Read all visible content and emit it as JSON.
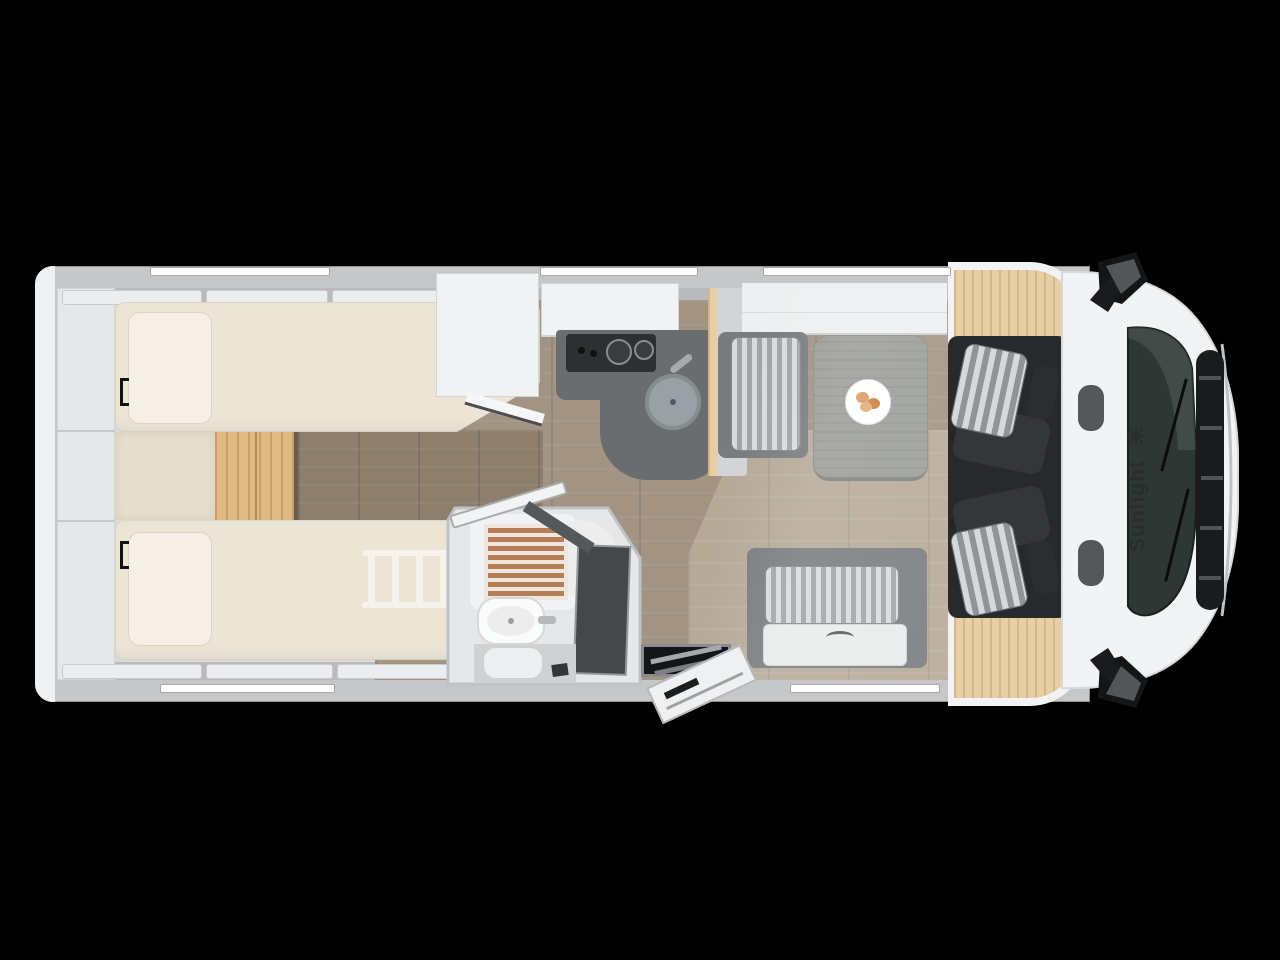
{
  "brand": {
    "label": "Sunlight",
    "logo_icon": "sun-rays-icon",
    "logo_text_color": "#2b2c2e"
  },
  "vehicle": {
    "view": "motorhome floor plan, top view",
    "orientation": "cab on right, rear on left"
  },
  "palette": {
    "background": "#000000",
    "body_white": "#f2f3f4",
    "wall_gray": "#c6c7c9",
    "interior_gray": "#d9dadb",
    "floor_wood": "#a29382",
    "walkway_wood": "#8d7e6d",
    "dinette_wood": "#b6a998",
    "step_wood": "#e0b983",
    "dashboard_wood": "#e7cfa3",
    "mattress_cream": "#ece5d6",
    "pillow_cream": "#f4f0e6",
    "counter_gray": "#696d70",
    "cooktop_black": "#2d2f31",
    "sink_gray": "#9aa1a4",
    "cushion_stripe_light": "#d8dadb",
    "cushion_stripe_dark": "#a0a4a7",
    "table_gray": "#9b9d99",
    "shower_slat_brown": "#b67e57",
    "cab_seat_dark": "#353638",
    "cab_floor_dark": "#28292b",
    "windshield_dark": "#2e3734",
    "mirror_black": "#141516"
  },
  "icons": [
    "sun-rays-icon",
    "side-mirror-icon",
    "wiper-icon",
    "burner-icon",
    "sink-icon",
    "faucet-icon",
    "plate-icon",
    "ladder-icon",
    "grab-handle-icon",
    "door-handle-icon",
    "step-tread-icon",
    "shower-mat-icon"
  ]
}
